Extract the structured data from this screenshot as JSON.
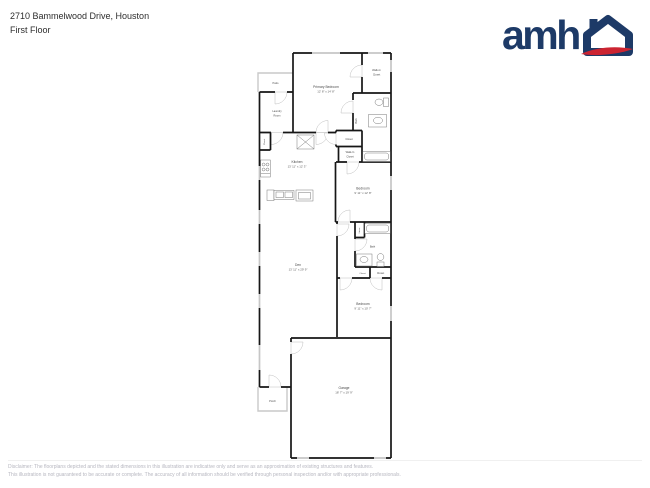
{
  "header": {
    "address": "2710 Bammelwood Drive, Houston",
    "floor_label": "First Floor"
  },
  "logo": {
    "wordmark": "amh",
    "navy": "#1d3a67",
    "red": "#cc2431"
  },
  "floorplan": {
    "rooms": {
      "patio": {
        "label": "Patio"
      },
      "laundry": {
        "lines": [
          "Laundry",
          "Room"
        ]
      },
      "closet_kitchen": {
        "label": "Closet"
      },
      "primary_bedroom": {
        "label": "Primary Bedroom",
        "dims": "12' 8\" x 14' 8\""
      },
      "walkin_closet_primary": {
        "lines": [
          "Walk-In",
          "Closet"
        ]
      },
      "primary_bath": {
        "label": "Bath"
      },
      "closet_hall": {
        "label": "Closet"
      },
      "walkin_closet_hall": {
        "lines": [
          "Walk-In",
          "Closet"
        ]
      },
      "kitchen": {
        "label": "Kitchen",
        "dims": "13' 11\" x 12' 3\""
      },
      "bedroom_1": {
        "label": "Bedroom",
        "dims": "9' 11\" x 12' 8\""
      },
      "den": {
        "label": "Den",
        "dims": "13' 11\" x 29' 9\""
      },
      "bath_2": {
        "label": "Bath"
      },
      "linen": {
        "label": "Linen"
      },
      "closet_small": {
        "label": "Closet"
      },
      "closet_bedroom_2": {
        "label": "Closet"
      },
      "bedroom_2": {
        "label": "Bedroom",
        "dims": "9' 11\" x 10' 7\""
      },
      "garage": {
        "label": "Garage",
        "dims": "18' 7\" x 19' 9\""
      },
      "porch": {
        "label": "Porch"
      }
    }
  },
  "footer": {
    "line1": "Disclaimer: The floorplans depicted and the stated dimensions in this illustration are indicative only and serve as an approximation of existing structures and features.",
    "line2": "This illustration is not guaranteed to be accurate or complete. The accuracy of all information should be verified through personal inspection and/or with appropriate professionals."
  }
}
